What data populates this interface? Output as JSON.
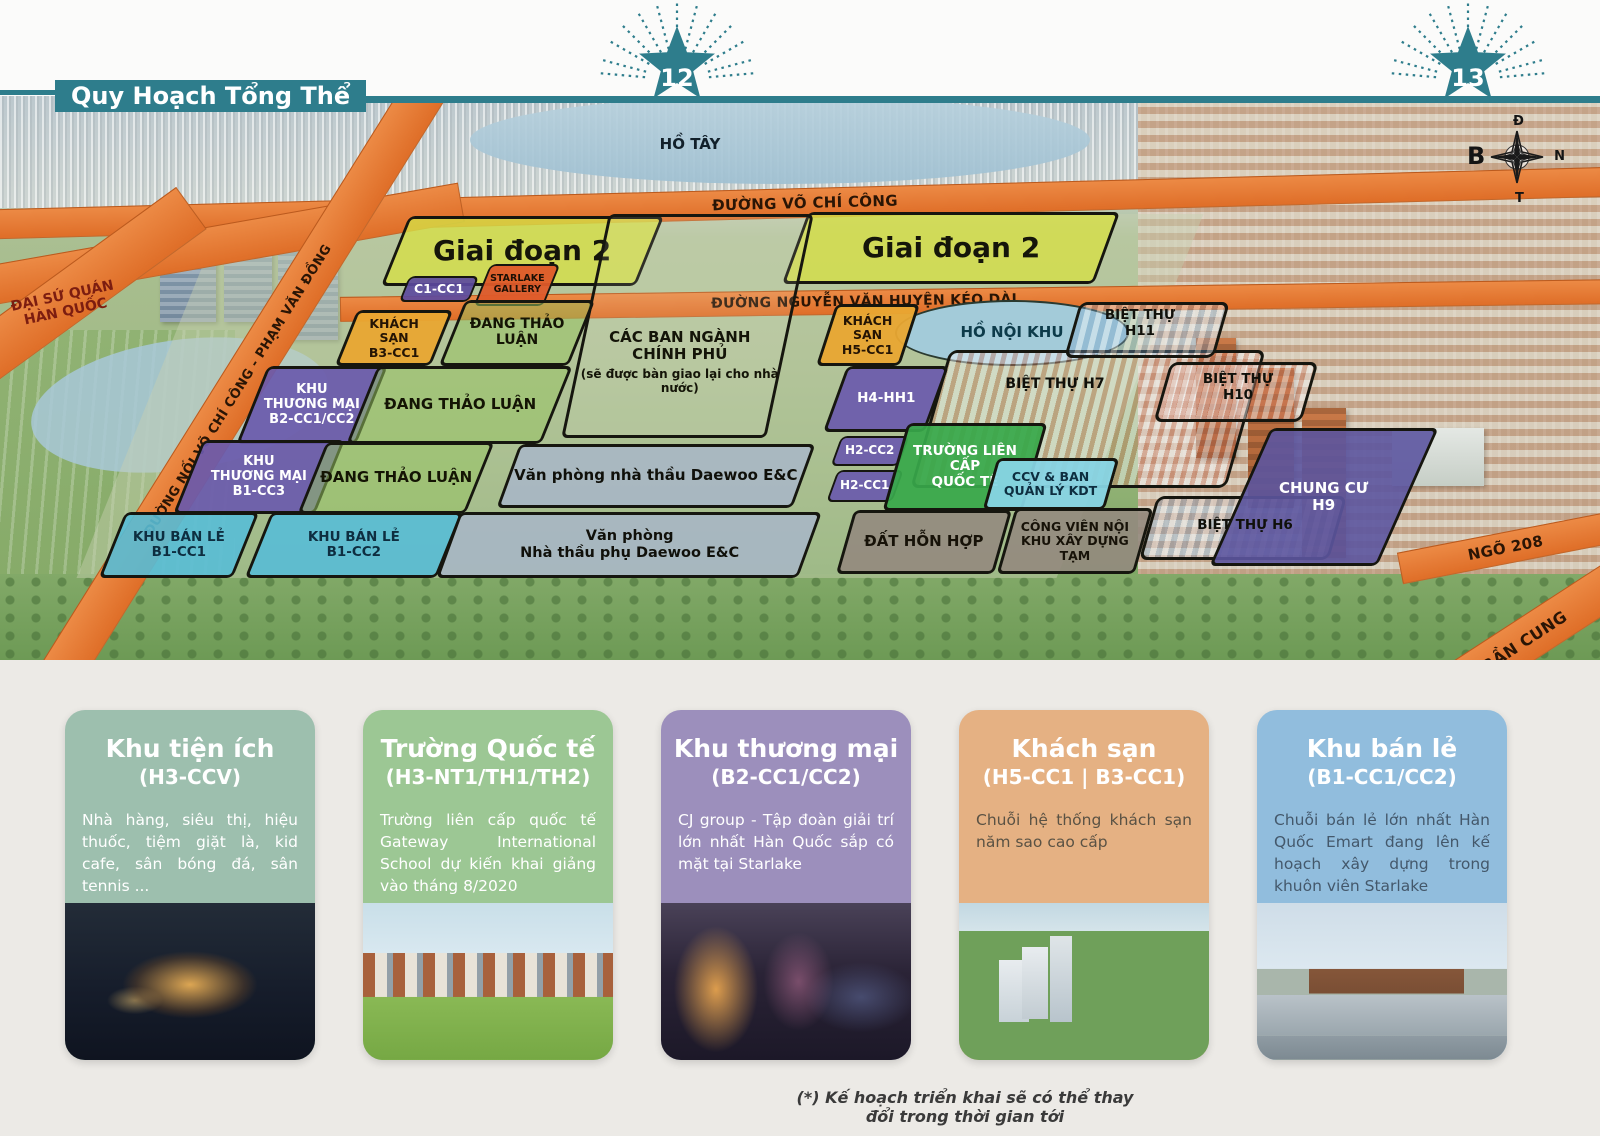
{
  "banner": {
    "title": "Quy Hoạch Tổng Thể"
  },
  "markers": {
    "left": "12",
    "right": "13"
  },
  "compass": {
    "top": "Đ",
    "right": "N",
    "bottom": "T",
    "left": "B"
  },
  "colors": {
    "teal": "#2e7d8c",
    "road_orange": "#e4762e",
    "zone_purple": "#6a5aac",
    "zone_yellow": "#d8de46",
    "zone_green_discuss": "#9ac364",
    "zone_cyan": "#58bcd6",
    "zone_orange_hotel": "#e9a732",
    "zone_school_green": "#38a84a",
    "zone_gray": "#948a7e",
    "zone_office_gray": "#a8b6ca",
    "chung_cu_purple": "#5c55a0"
  },
  "map": {
    "water": {
      "ho_tay": "HỒ TÂY",
      "ho_noi_khu": "HỒ NỘI KHU"
    },
    "roads": {
      "vo_chi_cong": "ĐƯỜNG VÕ CHÍ CÔNG",
      "nguyen_van_huyen": "ĐƯỜNG NGUYỄN VĂN HUYỆN KÉO DÀI",
      "noi_vcc_pvd": "ĐƯỜNG NỐI VÕ CHÍ CÔNG - PHẠM VĂN ĐỒNG",
      "ngo_208": "NGÕ 208",
      "tran_cung": "TRẦN CUNG"
    },
    "landmarks": {
      "embassy": "ĐẠI SỨ QUÁN\nHÀN QUỐC",
      "bt_h11": "BIỆT THỰ\nH11",
      "bt_h7": "BIỆT THỰ H7",
      "bt_h10": "BIỆT THỰ\nH10",
      "bt_h6": "BIỆT THỰ H6"
    },
    "zones": [
      {
        "label": "Giai đoạn 2"
      },
      {
        "label": "C1-CC1"
      },
      {
        "label": "STARLAKE\nGALLERY"
      },
      {
        "label": "Giai đoạn 2"
      },
      {
        "label": "CÁC BAN NGÀNH\nCHÍNH PHỦ",
        "note": "(sẽ được bàn giao lại cho nhà nước)"
      },
      {
        "label": "KHÁCH\nSẠN\nB3-CC1"
      },
      {
        "label": "ĐANG THẢO LUẬN"
      },
      {
        "label": "KHU\nTHƯƠNG MẠI\nB2-CC1/CC2"
      },
      {
        "label": "ĐANG THẢO LUẬN"
      },
      {
        "label": "KHU\nTHƯƠNG MẠI\nB1-CC3"
      },
      {
        "label": "ĐANG THẢO LUẬN"
      },
      {
        "label": "KHU BÁN LẺ\nB1-CC1"
      },
      {
        "label": "KHU BÁN LẺ\nB1-CC2"
      },
      {
        "label": "Văn phòng nhà thầu Daewoo E&C"
      },
      {
        "label": "Văn phòng\nNhà thầu phụ Daewoo E&C"
      },
      {
        "label": "KHÁCH\nSẠN\nH5-CC1"
      },
      {
        "label": "H4-HH1"
      },
      {
        "label": "H2-CC2"
      },
      {
        "label": "H2-CC1"
      },
      {
        "label": "TRƯỜNG LIÊN CẤP\nQUỐC TẾ"
      },
      {
        "label": "CCV & BAN\nQUẢN LÝ KDT"
      },
      {
        "label": "ĐẤT HỖN HỢP"
      },
      {
        "label": "CÔNG VIÊN NỘI\nKHU XÂY DỰNG TẠM"
      },
      {
        "label": "CHUNG CƯ\nH9"
      }
    ]
  },
  "cards": [
    {
      "title": "Khu tiện ích",
      "code": "(H3-CCV)",
      "accent": "#9dbfae",
      "body": "Nhà hàng, siêu thị, hiệu thuốc, tiệm giặt là, kid cafe, sân bóng đá, sân tennis ..."
    },
    {
      "title": "Trường Quốc tế",
      "code": "(H3-NT1/TH1/TH2)",
      "accent": "#9cc794",
      "body": "Trường liên cấp quốc tế Gateway International School dự kiến khai giảng vào tháng 8/2020"
    },
    {
      "title": "Khu thương mại",
      "code": "(B2-CC1/CC2)",
      "accent": "#9c8fbc",
      "body": "CJ group - Tập đoàn giải trí lớn nhất Hàn Quốc sắp có mặt tại Starlake"
    },
    {
      "title": "Khách sạn",
      "code": "(H5-CC1 | B3-CC1)",
      "accent": "#e5b183",
      "body": "Chuỗi hệ thống khách sạn năm sao cao cấp"
    },
    {
      "title": "Khu bán lẻ",
      "code": "(B1-CC1/CC2)",
      "accent": "#91bddd",
      "body": "Chuỗi bán lẻ lớn nhất Hàn Quốc Emart đang lên kế hoạch xây dựng trong khuôn viên Starlake"
    }
  ],
  "footnote": "(*) Kế hoạch triển khai sẽ có thể thay đổi trong thời gian tới"
}
